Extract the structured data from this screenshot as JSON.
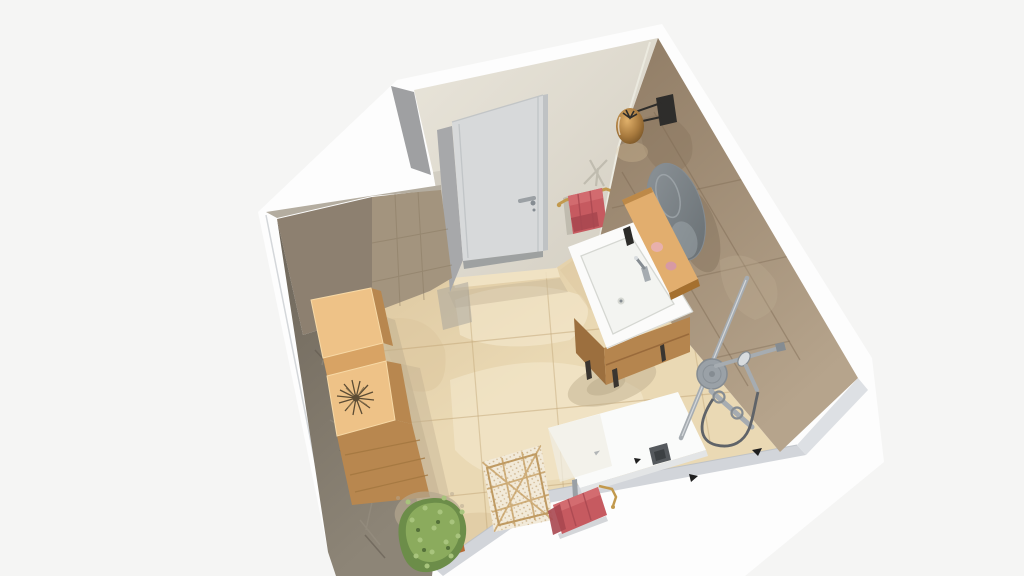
{
  "scene": {
    "kind": "3d-floorplan-render",
    "room": "bathroom",
    "view": "overhead-isometric-cutaway",
    "objects": [
      "entry-door",
      "wall-lamp",
      "round-mirror",
      "wood-wall-shelf",
      "soap-set",
      "vanity-cabinet-with-sink",
      "door-towel-rail",
      "red-towel",
      "tiled-right-wall",
      "tiled-left-wall",
      "shower-column-set",
      "shower-tray",
      "storage-cabinets",
      "dried-grass-decor",
      "berber-rug",
      "front-towel-rail",
      "red-towel-front",
      "green-plant",
      "travertine-floor"
    ]
  },
  "colors": {
    "bg": "#f5f5f4",
    "shell": "#fdfdfd",
    "bandGray": "#d2d5da",
    "bandBevel": "#dde0e4",
    "bandLine": "#b9bec4",
    "outerWedge": "#9fa0a2",
    "floorBase": "#ead9b4",
    "floorLight": "#f5ebd1",
    "floorDark": "#dcc69e",
    "floorLine": "#c2a678",
    "floorShadow": "#c0b090",
    "thresholdLight": "#f2e6c9",
    "doorFloorShadow": "#c5b698",
    "revealFloorShade": "#a9a69c",
    "backWallA": "#e9e5da",
    "backWallB": "#d3cec2",
    "backWallShade": "#c8c3b7",
    "cornerTrim": "#efede3",
    "reveal": "#a7a8aa",
    "door": "#d7d9da",
    "doorEdge": "#bfc2c4",
    "doorShadow": "#8f9396",
    "handleChrome": "#9ba0a4",
    "towelRed": "#c65a60",
    "towelRedDark": "#a84750",
    "towelRedLight": "#d46e72",
    "towelBandShadow": "#b9bcc2",
    "brass": "#c2994d",
    "shadowOnWall": "#b5b0a4",
    "cornerDark": "#8d8070",
    "cornerLight": "#a3947e",
    "cornerTop": "#b4ada0",
    "tileJoint": "#8a7a62",
    "leftWallA": "#6e665a",
    "leftWallB": "#8d8577",
    "leftStreak": "#9a9183",
    "leftStreakDark": "#5b5449",
    "rightWallA": "#8f7b64",
    "rightWallB": "#b6a48c",
    "rightJoint": "#7c6952",
    "rightPatchDark": "#846f58",
    "rightPatchLight": "#bfae94",
    "lampBlack": "#2e2d2b",
    "lampAmber1": "#e0b06a",
    "lampAmber2": "#a87a3e",
    "lampAmber3": "#6b4a20",
    "lampGlow": "#d9c49b",
    "mirrorA": "#8d9499",
    "mirrorB": "#6d7478",
    "mirrorRing": "#a5acb1",
    "mirrorShadow": "#6f5f4c",
    "shelfTop": "#e2ae6e",
    "shelfFront": "#a5702f",
    "soapPink1": "#e8b0ac",
    "soapPink2": "#d79aa4",
    "sink": "#fbfbfa",
    "sinkLine": "#d5d7d2",
    "basin": "#f3f4f1",
    "vanityWoodFront": "#b5854e",
    "vanityWoodSide": "#9c6f3e",
    "vanityLine": "#96673a",
    "legDark": "#3a3530",
    "bottleBlack": "#2c2b29",
    "chrome": "#a6acb1",
    "chromeLight": "#d8dcdf",
    "chromeDark": "#858c92",
    "headGray": "#9aa1a7",
    "hose": "#5f6368",
    "tray": "#fafbfa",
    "trayEdge": "#e3e5e6",
    "trayShade": "#efeee4",
    "drainA": "#55595d",
    "drainB": "#3c4043",
    "clipBlack": "#1f1f1f",
    "rugBase": "#f2ead9",
    "rugLine": "#c59f63",
    "rugBorder": "#bf9a62",
    "rugDot": "#c9ad83",
    "woodTop": "#eec287",
    "woodTopEdge": "#f7d9a6",
    "woodFront": "#d8a364",
    "woodSide": "#b8874f",
    "woodSideLine": "#a1753f",
    "grassDry": "#5c4c34",
    "grassDryLight": "#8a7450",
    "plantShadow": "#b3a68f",
    "green1": "#6c8d49",
    "green2": "#8fae5f",
    "green3": "#a8c47d",
    "green4": "#55713a",
    "pot": "#b66a35",
    "potRim": "#8f4f24",
    "railGray": "#9aa0a5"
  }
}
